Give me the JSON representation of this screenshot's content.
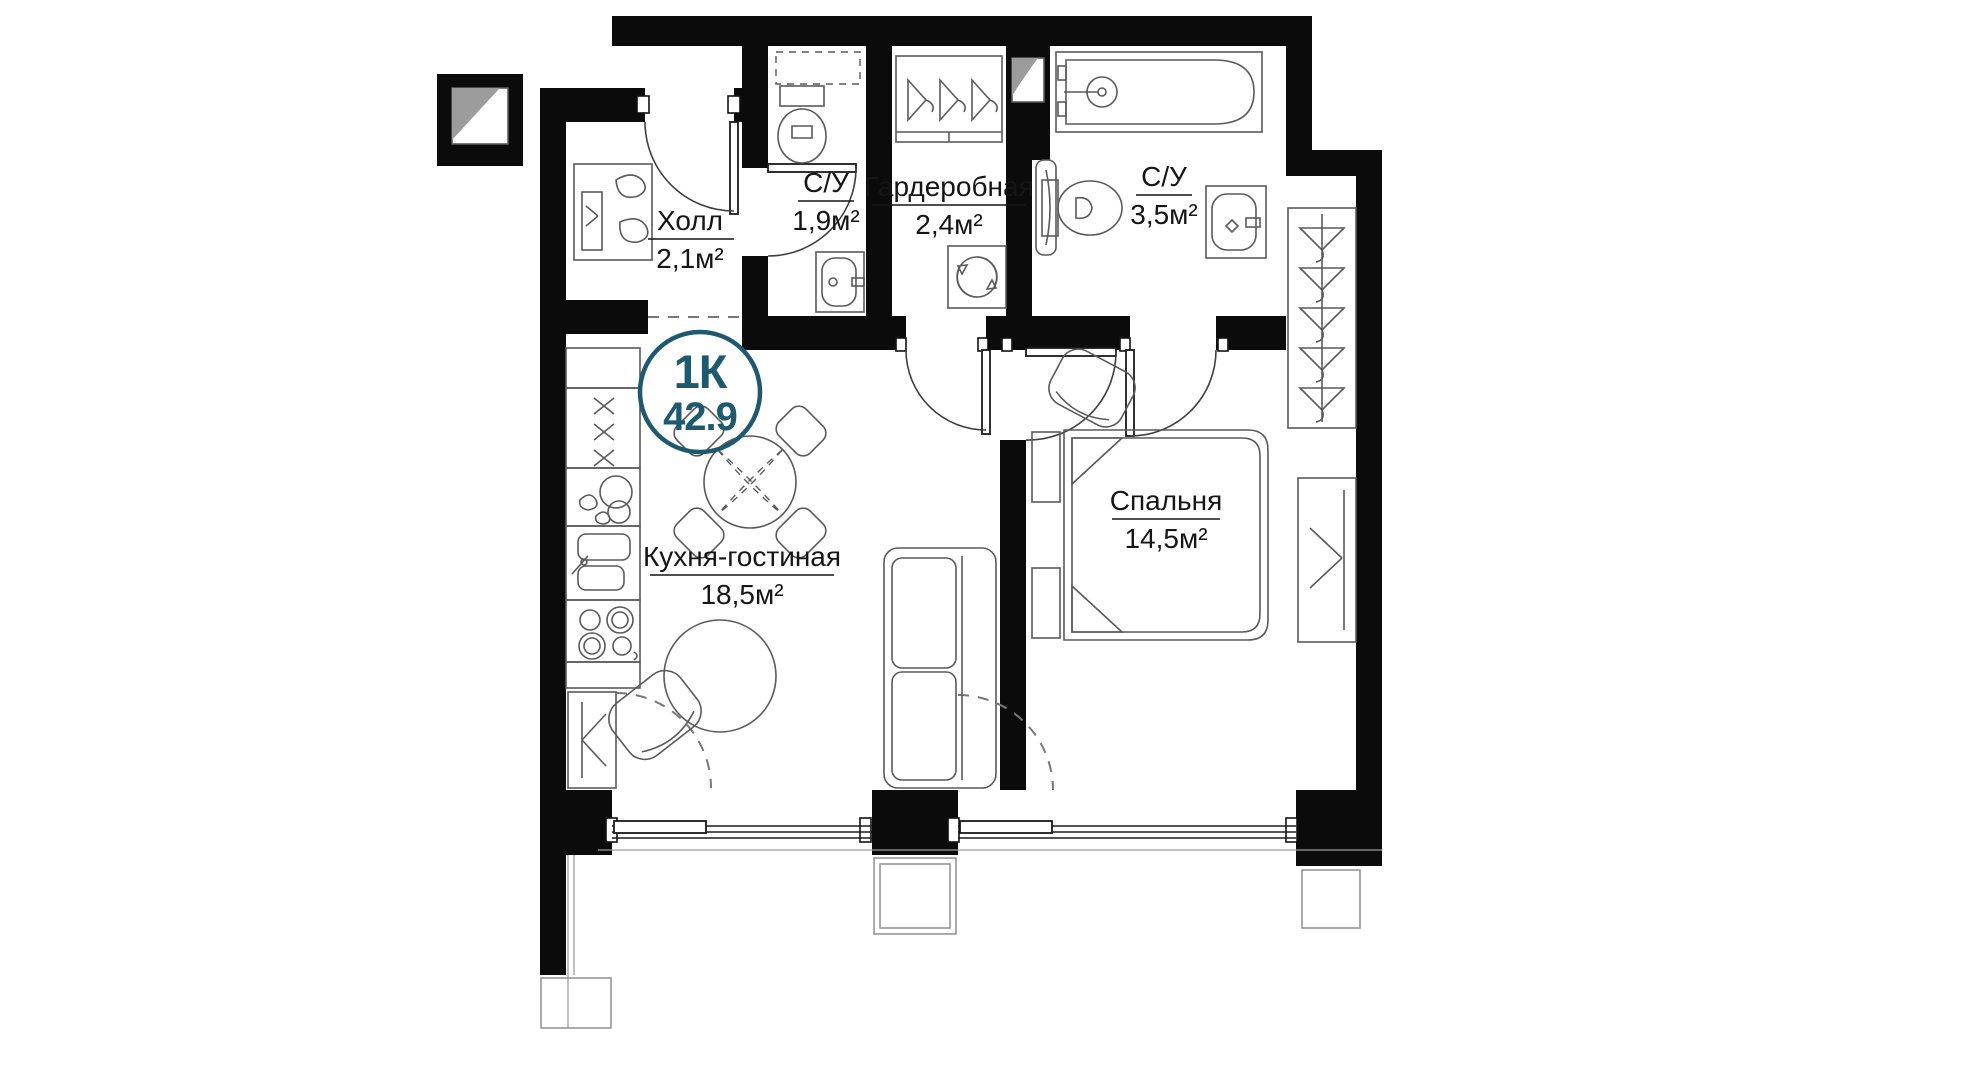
{
  "badge": {
    "rooms": "1К",
    "area": "42.9",
    "color": "#1d5a70"
  },
  "rooms": [
    {
      "id": "hall",
      "name": "Холл",
      "area": "2,1м²"
    },
    {
      "id": "wc-small",
      "name": "С/У",
      "area": "1,9м²"
    },
    {
      "id": "wardrobe",
      "name": "Гардеробная",
      "area": "2,4м²"
    },
    {
      "id": "wc-big",
      "name": "С/У",
      "area": "3,5м²"
    },
    {
      "id": "kitchen-living",
      "name": "Кухня-гостиная",
      "area": "18,5м²"
    },
    {
      "id": "bedroom",
      "name": "Спальня",
      "area": "14,5м²"
    }
  ],
  "colors": {
    "walls": "#0b0b0b",
    "furniture": "#5a5a5a",
    "accent": "#1d5a70"
  }
}
